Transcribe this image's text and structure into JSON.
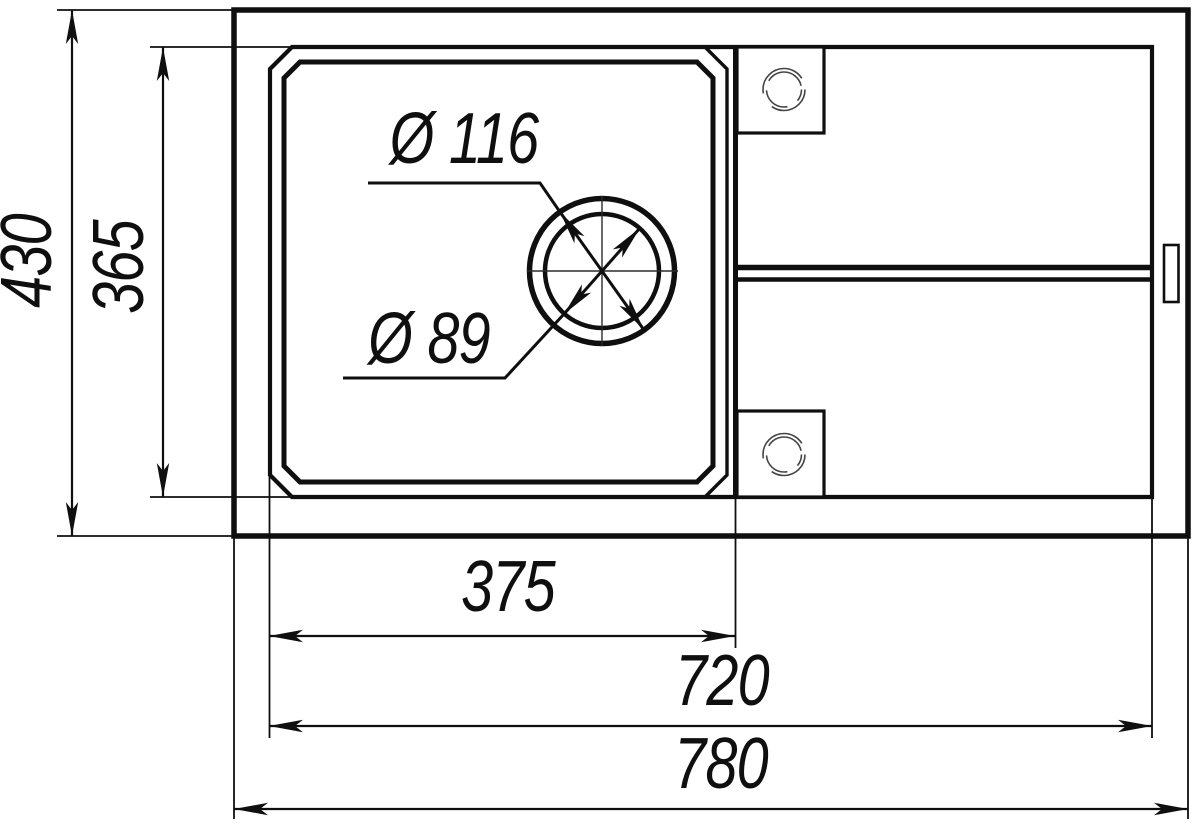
{
  "drawing": {
    "background": "#ffffff",
    "line_color": "#0f0f0f",
    "dims": {
      "overall_depth": "430",
      "bowl_depth": "365",
      "bowl_width": "375",
      "inner_width": "720",
      "overall_width": "780",
      "drain_flange_diameter": "Ø 116",
      "drain_hole_diameter": "Ø 89"
    }
  }
}
